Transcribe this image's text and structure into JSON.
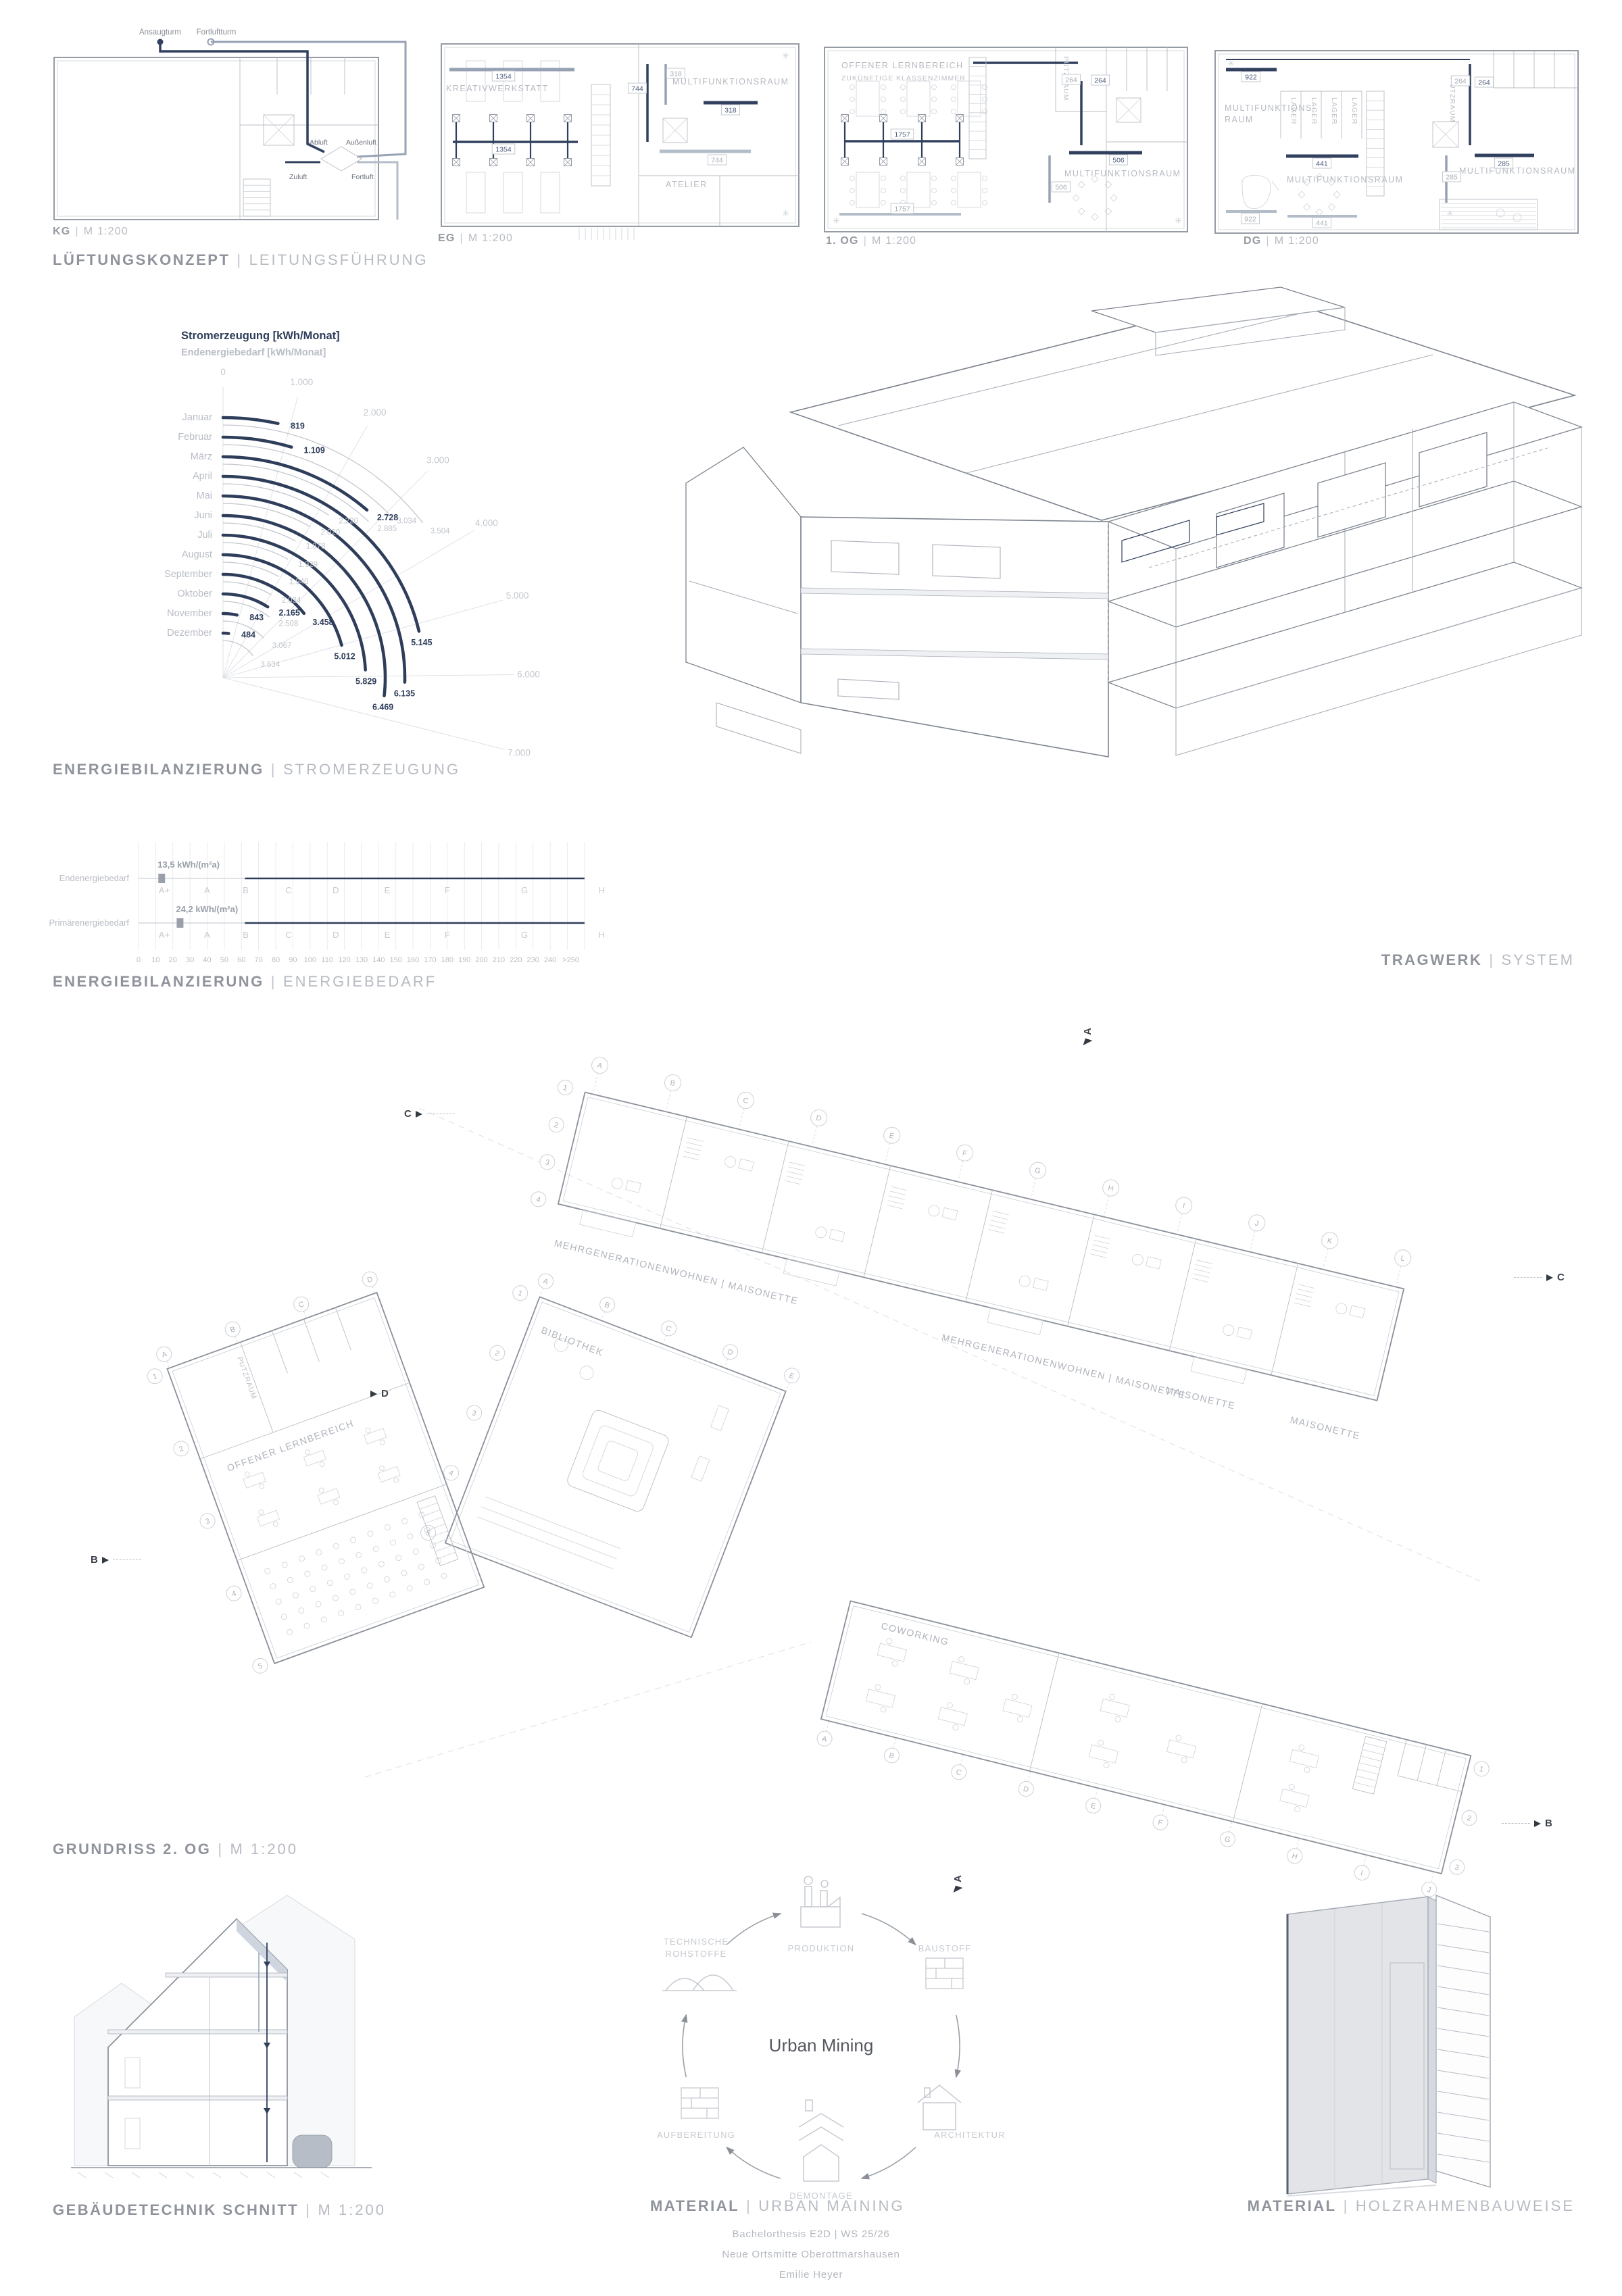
{
  "ui": {
    "sep": "|"
  },
  "lueftung": {
    "title_bold": "LÜFTUNGSKONZEPT",
    "title_light": "LEITUNGSFÜHRUNG",
    "plans": [
      {
        "name": "KG",
        "scale": "M 1:200"
      },
      {
        "name": "EG",
        "scale": "M 1:200"
      },
      {
        "name": "1. OG",
        "scale": "M 1:200"
      },
      {
        "name": "DG",
        "scale": "M 1:200"
      }
    ],
    "kg": {
      "ansaugturm": "Ansaugturm",
      "fortluftturm": "Fortluftturm",
      "abluft": "Abluft",
      "aussenluft": "Außenluft",
      "zuluft": "Zuluft",
      "fortluft": "Fortluft"
    },
    "eg": {
      "rooms": [
        "KREATIVWERKSTATT",
        "MULTIFUNKTIONSRAUM",
        "ATELIER"
      ],
      "ducts": [
        "1354",
        "1354",
        "744",
        "744",
        "318",
        "318"
      ]
    },
    "og1": {
      "rooms": [
        "OFFENER LERNBEREICH",
        "ZUKÜNFTIGE KLASSENZIMMER",
        "PUTZRAUM",
        "MULTIFUNKTIONSRAUM"
      ],
      "ducts": [
        "1757",
        "1757",
        "264",
        "264",
        "506",
        "506"
      ]
    },
    "dg": {
      "rooms": [
        "MULTIFUNKTIONS-",
        "RAUM",
        "LAGER",
        "PUTZRAUM",
        "MULTIFUNKTIONSRAUM",
        "MULTIFUNKTIONSRAUM"
      ],
      "ducts": [
        "922",
        "922",
        "441",
        "441",
        "264",
        "264",
        "285",
        "285"
      ]
    }
  },
  "energie_strom": {
    "title_bold": "ENERGIEBILANZIERUNG",
    "title_light": "STROMERZEUGUNG"
  },
  "energie_bedarf": {
    "title_bold": "ENERGIEBILANZIERUNG",
    "title_light": "ENERGIEBEDARF"
  },
  "tragwerk": {
    "title_bold": "TRAGWERK",
    "title_light": "SYSTEM"
  },
  "grundriss": {
    "title_bold": "GRUNDRISS 2. OG",
    "title_light": "M 1:200",
    "labels": {
      "wohnen": "MEHRGENERATIONENWOHNEN | MAISONETTE",
      "maisonette": "MAISONETTE",
      "bibliothek": "BIBLIOTHEK",
      "coworking": "COWORKING",
      "putzraum": "PUTZRAUM",
      "lernbereich": "OFFENER LERNBEREICH"
    },
    "markers": {
      "a": "A",
      "b": "B",
      "c": "C",
      "d": "D"
    },
    "grid": {
      "bar1_top": [
        "A",
        "B",
        "C",
        "D",
        "E",
        "F",
        "G",
        "H",
        "I",
        "J",
        "K",
        "L"
      ],
      "bar1_left": [
        "1",
        "2",
        "3",
        "4"
      ],
      "bar2_top": [
        "A",
        "B",
        "C",
        "D",
        "E"
      ],
      "bar2_left": [
        "1",
        "2",
        "3",
        "4",
        "5"
      ],
      "bar3_bottom": [
        "A",
        "B",
        "C",
        "D",
        "E",
        "F",
        "G",
        "H",
        "I",
        "J"
      ],
      "bar3_right": [
        "1",
        "2",
        "3"
      ],
      "bar4_top": [
        "A",
        "B",
        "C",
        "D"
      ],
      "bar4_left": [
        "1",
        "2",
        "3",
        "4",
        "5"
      ]
    }
  },
  "gebaeudetechnik": {
    "title_bold": "GEBÄUDETECHNIK SCHNITT",
    "title_light": "M 1:200"
  },
  "material_mining": {
    "title_bold": "MATERIAL",
    "title_light": "URBAN MAINING",
    "center": "Urban Mining",
    "nodes": [
      "PRODUKTION",
      "BAUSTOFF",
      "ARCHITEKTUR",
      "DEMONTAGE",
      "AUFBEREITUNG",
      "TECHNISCHE ROHSTOFFE"
    ]
  },
  "material_holz": {
    "title_bold": "MATERIAL",
    "title_light": "HOLZRAHMENBAUWEISE"
  },
  "footer": {
    "line1": "Bachelorthesis E2D | WS 25/26",
    "line2": "Neue Ortsmitte Oberottmarshausen",
    "line3": "Emilie Heyer"
  },
  "chart_data": [
    {
      "type": "bar",
      "variant": "radial",
      "title": "Stromerzeugung [kWh/Monat]",
      "subtitle": "Endenergiebedarf [kWh/Monat]",
      "categories": [
        "Januar",
        "Februar",
        "März",
        "April",
        "Mai",
        "Juni",
        "Juli",
        "August",
        "September",
        "Oktober",
        "November",
        "Dezember"
      ],
      "series": [
        {
          "name": "Stromerzeugung",
          "color": "#2e3d5a",
          "values": [
            819,
            1109,
            2728,
            5145,
            6135,
            6469,
            5829,
            5012,
            3458,
            2165,
            843,
            484
          ]
        },
        {
          "name": "Endenergiebedarf",
          "color": "#c3c7ce",
          "values": [
            3504,
            3034,
            2885,
            2220,
            2020,
            1878,
            1929,
            1940,
            2034,
            2508,
            3067,
            3634
          ]
        }
      ],
      "axis": {
        "min": 0,
        "max": 7000,
        "ticks": [
          0,
          1000,
          2000,
          3000,
          4000,
          5000,
          6000,
          7000
        ]
      },
      "legend_position": "none",
      "grid": true
    },
    {
      "type": "bar",
      "variant": "energy-scale",
      "rows": [
        {
          "label": "Endenergiebedarf",
          "value": 13.5,
          "value_label": "13,5 kWh/(m²a)"
        },
        {
          "label": "Primärenergiebedarf",
          "value": 24.2,
          "value_label": "24,2 kWh/(m²a)"
        }
      ],
      "classes": [
        "A+",
        "A",
        "B",
        "C",
        "D",
        "E",
        "F",
        "G",
        "H"
      ],
      "class_bounds": [
        0,
        30,
        50,
        75,
        100,
        130,
        160,
        200,
        250,
        290
      ],
      "xlim": [
        0,
        260
      ],
      "axis_ticks": [
        "0",
        "10",
        "20",
        "30",
        "40",
        "50",
        "60",
        "70",
        "80",
        "90",
        "100",
        "110",
        "120",
        "130",
        "140",
        "150",
        "160",
        "170",
        "180",
        "190",
        "200",
        "210",
        "220",
        "230",
        "240",
        ">250"
      ]
    }
  ]
}
